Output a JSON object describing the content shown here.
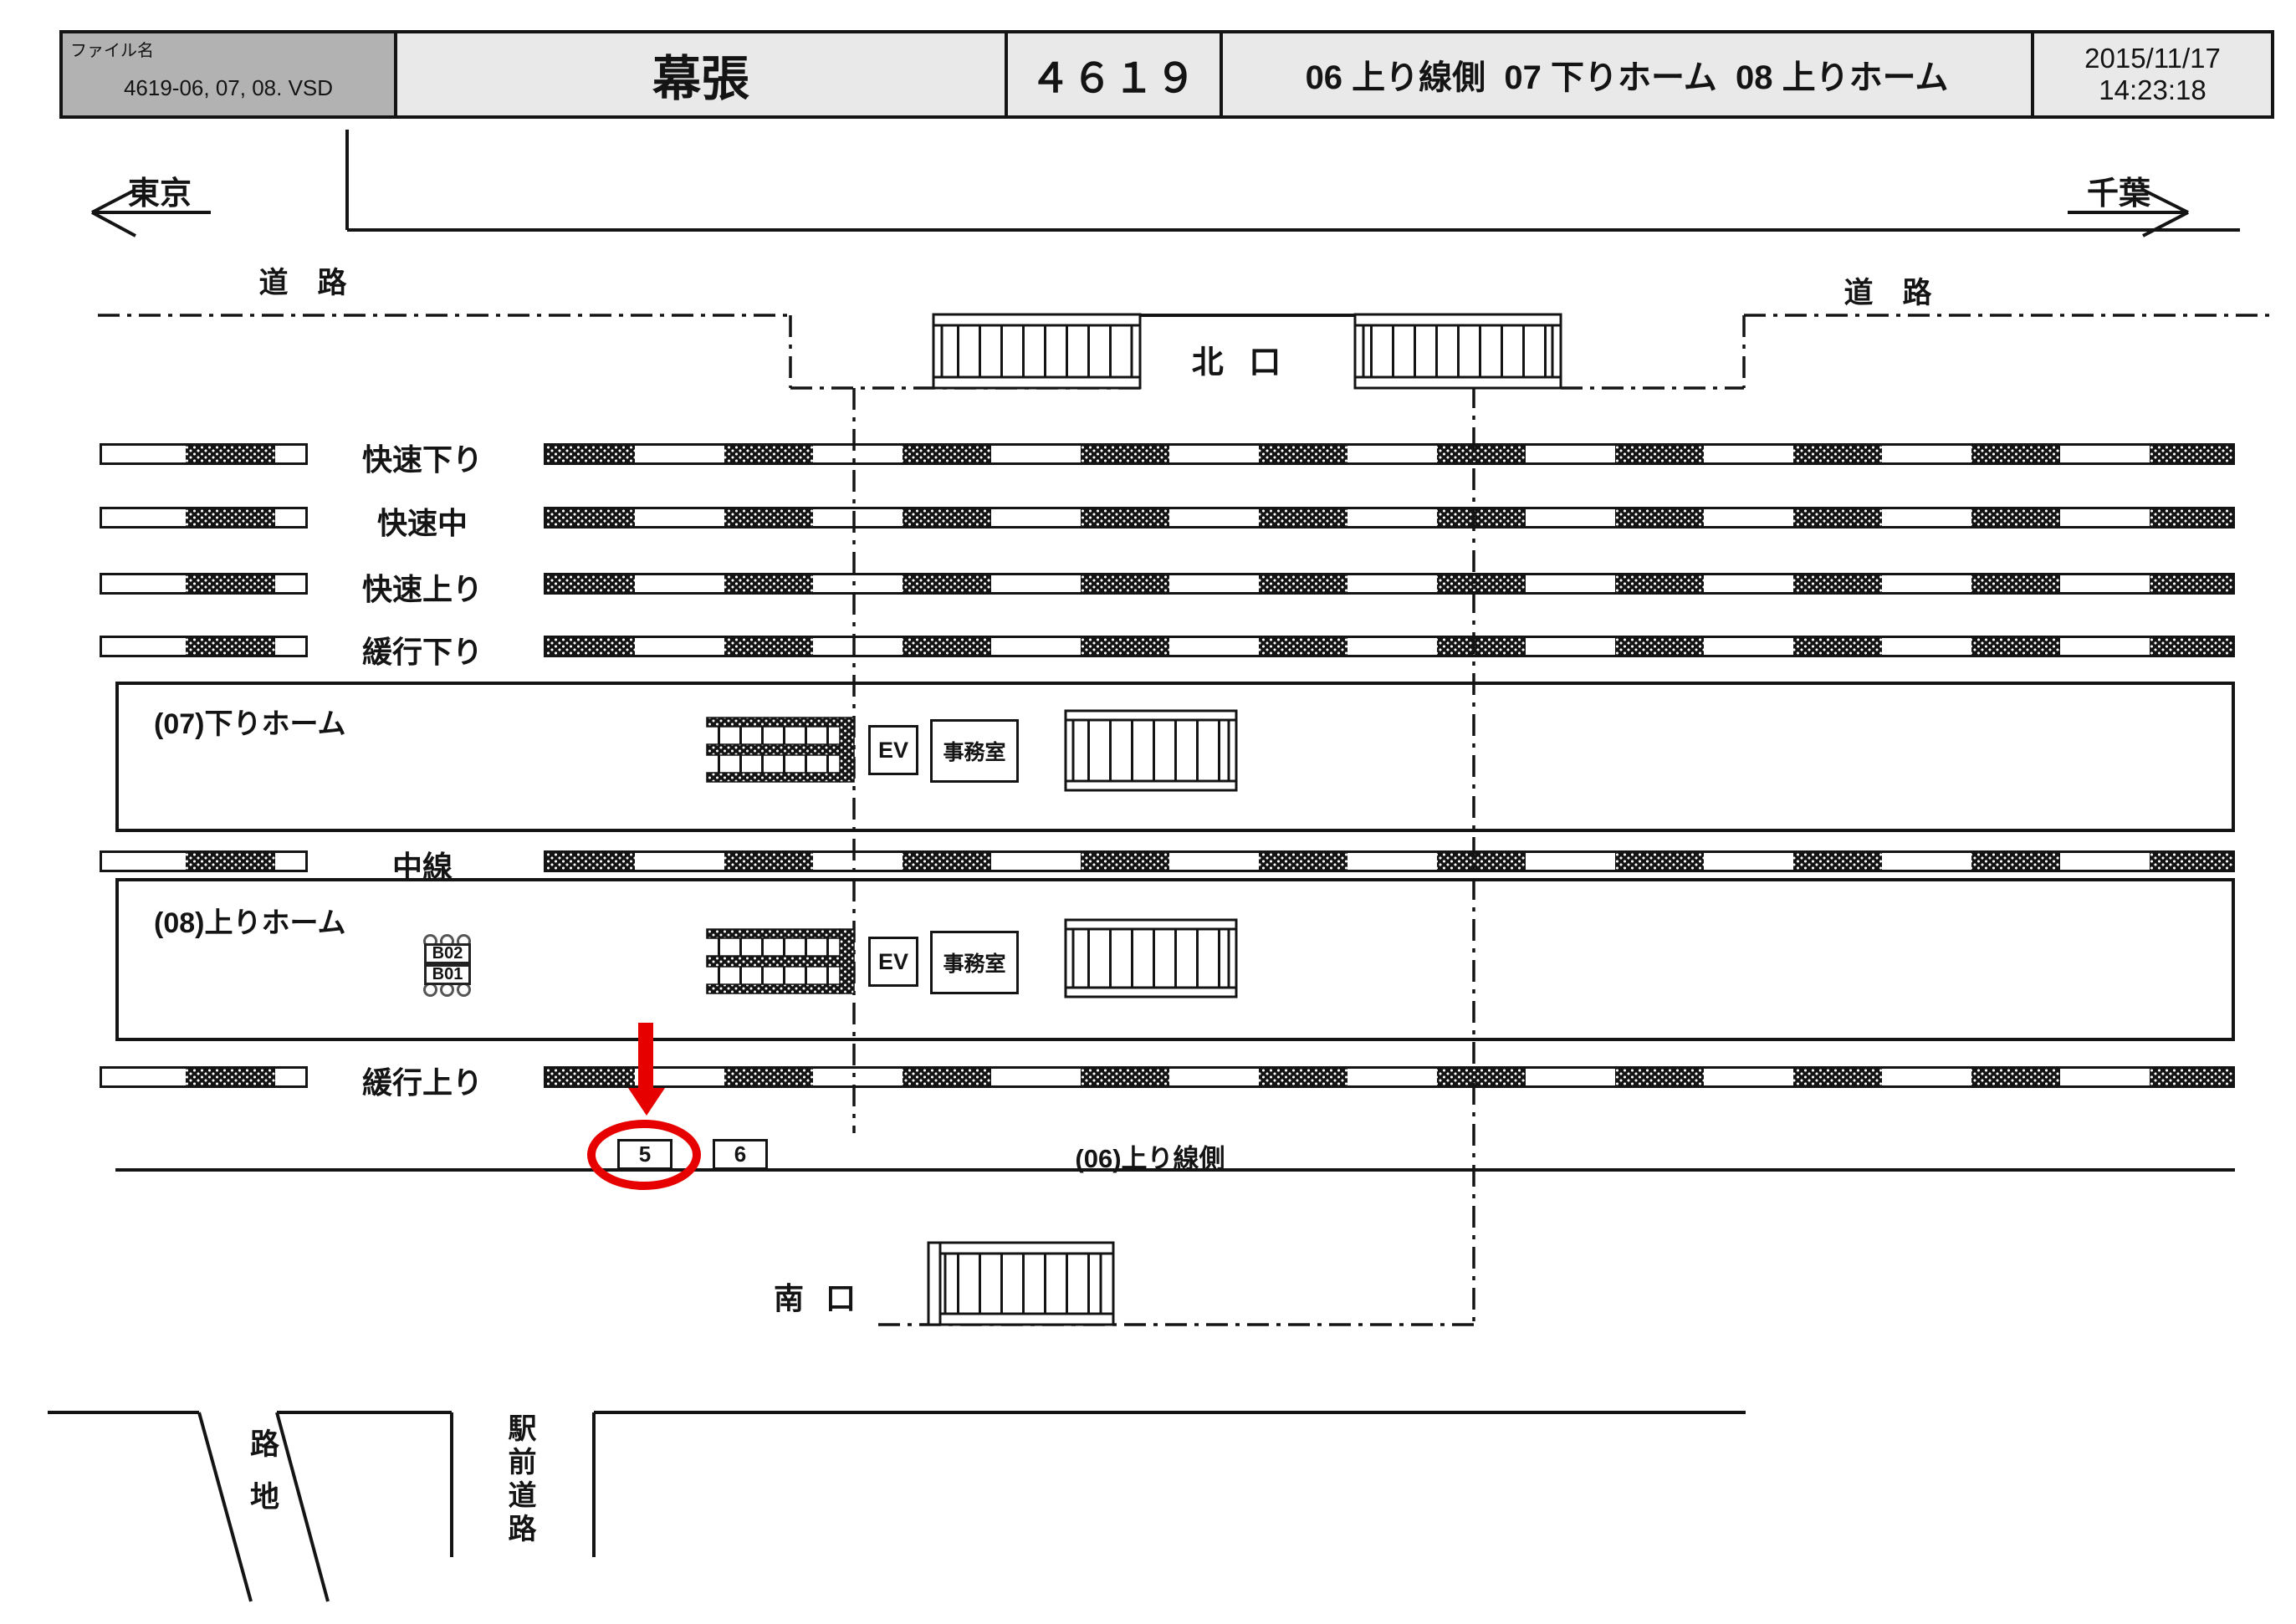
{
  "header": {
    "file_label": "ファイル名",
    "file_name": "4619-06, 07, 08. VSD",
    "station_name": "幕張",
    "drawing_number": "４６１９",
    "sheet_titles": "06 上り線側  07 下りホーム  08 上りホーム",
    "date": "2015/11/17",
    "time": "14:23:18"
  },
  "directions": {
    "left": "東京",
    "right": "千葉"
  },
  "roads": {
    "top_left": "道　路",
    "top_right": "道　路",
    "alley": "路地",
    "station_front": "駅前道路"
  },
  "exits": {
    "north": "北 口",
    "south": "南 口"
  },
  "tracks": [
    {
      "label": "快速下り"
    },
    {
      "label": "快速中"
    },
    {
      "label": "快速上り"
    },
    {
      "label": "緩行下り"
    },
    {
      "label": "中線"
    },
    {
      "label": "緩行上り"
    }
  ],
  "platforms": [
    {
      "label": "(07)下りホーム"
    },
    {
      "label": "(08)上りホーム"
    }
  ],
  "facilities": {
    "elevator": "EV",
    "office": "事務室"
  },
  "trackside": {
    "label": "(06)上り線側"
  },
  "ad_positions": {
    "circled": "5",
    "plain": "6",
    "pillar_top": "B02",
    "pillar_bottom": "B01"
  },
  "colors": {
    "highlight_red": "#e60000",
    "header_gray": "#b2b2b2",
    "header_light": "#e9e9e9",
    "line": "#141414"
  }
}
